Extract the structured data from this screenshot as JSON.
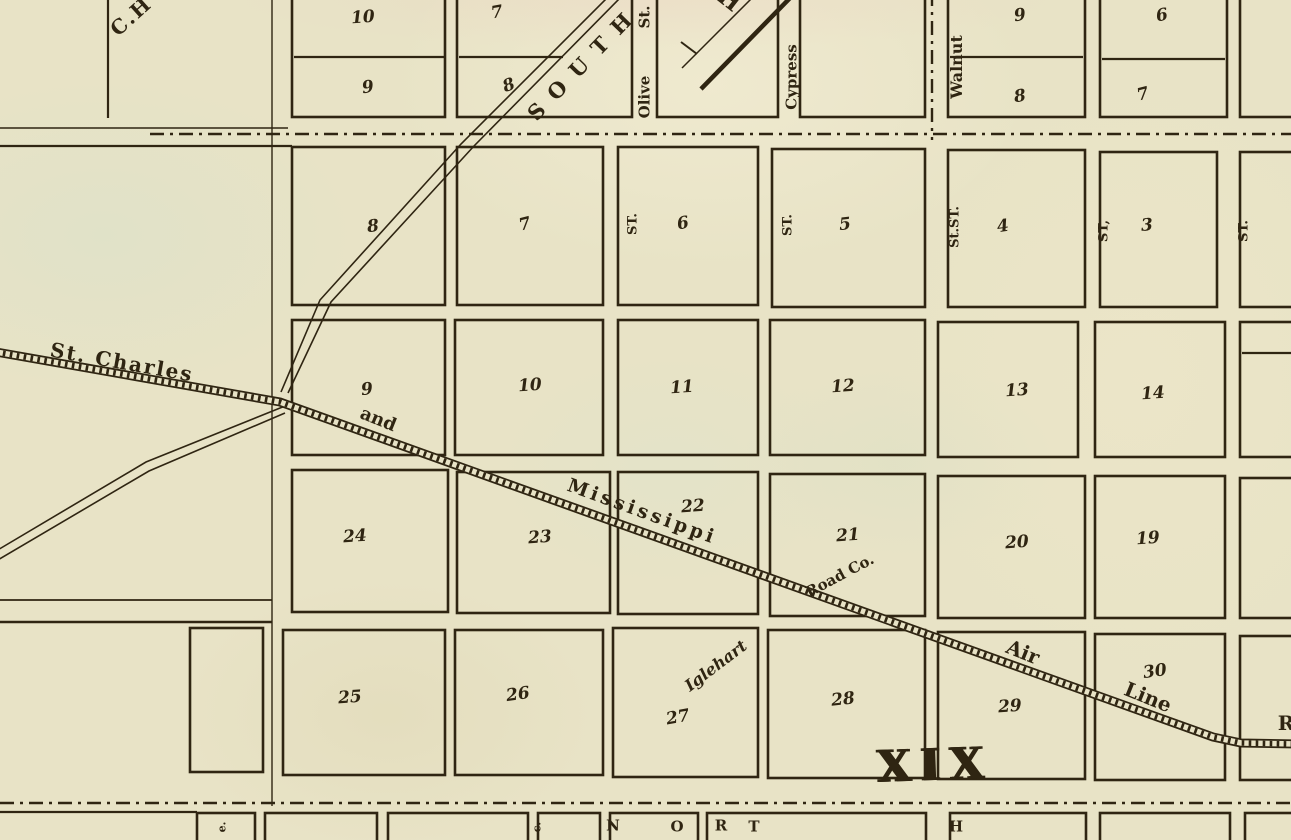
{
  "map": {
    "paper_color": "#e8e3c6",
    "ink_color": "#2f2512",
    "labels": [
      {
        "name": "partial-label-c-h",
        "text": "C.H",
        "x": 131,
        "y": 16,
        "rot": -42,
        "size": 20,
        "ls": 2,
        "w": 700
      },
      {
        "name": "road-label-south",
        "text": "SOUTH",
        "x": 584,
        "y": 62,
        "rot": -46,
        "size": 21,
        "ls": 13,
        "w": 700
      },
      {
        "name": "partial-label-h",
        "text": "H",
        "x": 729,
        "y": 0,
        "rot": 38,
        "size": 23,
        "w": 700
      },
      {
        "name": "street-label-olive",
        "text": "Olive",
        "x": 645,
        "y": 97,
        "rot": -90,
        "size": 15,
        "w": 700
      },
      {
        "name": "street-label-olive-st",
        "text": "St.",
        "x": 645,
        "y": 17,
        "rot": -90,
        "size": 15,
        "w": 700
      },
      {
        "name": "street-label-cypress",
        "text": "Cypress",
        "x": 792,
        "y": 77,
        "rot": -90,
        "size": 15,
        "w": 700
      },
      {
        "name": "street-label-walnut",
        "text": "Walnut",
        "x": 957,
        "y": 67,
        "rot": -90,
        "size": 16,
        "w": 700
      },
      {
        "name": "street-label-st-1",
        "text": "ST.",
        "x": 633,
        "y": 224,
        "rot": -90,
        "size": 13,
        "w": 700
      },
      {
        "name": "street-label-st-2",
        "text": "ST.",
        "x": 788,
        "y": 225,
        "rot": -90,
        "size": 13,
        "w": 700
      },
      {
        "name": "street-label-st-3",
        "text": "St.ST.",
        "x": 955,
        "y": 227,
        "rot": -90,
        "size": 13,
        "w": 700
      },
      {
        "name": "street-label-st-4",
        "text": "ST,",
        "x": 1104,
        "y": 231,
        "rot": -90,
        "size": 13,
        "w": 700
      },
      {
        "name": "street-label-st-5",
        "text": "ST.",
        "x": 1244,
        "y": 231,
        "rot": -90,
        "size": 13,
        "w": 700
      },
      {
        "name": "railroad-label-st-charles",
        "text": "St. Charles",
        "x": 122,
        "y": 362,
        "rot": 10,
        "size": 20,
        "ls": 2,
        "w": 700
      },
      {
        "name": "railroad-label-and",
        "text": "and",
        "x": 378,
        "y": 420,
        "rot": 22,
        "size": 18,
        "w": 700
      },
      {
        "name": "railroad-label-mississippi",
        "text": "Mississippi",
        "x": 642,
        "y": 512,
        "rot": 20,
        "size": 19,
        "ls": 3.5,
        "w": 700
      },
      {
        "name": "railroad-label-road-co",
        "text": "Road Co.",
        "x": 840,
        "y": 576,
        "rot": -28,
        "size": 15,
        "w": 700
      },
      {
        "name": "railroad-label-air",
        "text": "Air",
        "x": 1023,
        "y": 652,
        "rot": 22,
        "size": 20,
        "w": 700
      },
      {
        "name": "railroad-label-line",
        "text": "Line",
        "x": 1148,
        "y": 697,
        "rot": 22,
        "size": 20,
        "w": 700
      },
      {
        "name": "partial-label-r",
        "text": "R",
        "x": 1286,
        "y": 723,
        "rot": 0,
        "size": 20,
        "w": 700
      },
      {
        "name": "owner-label-iglehart",
        "text": "Iglehart",
        "x": 716,
        "y": 666,
        "rot": -37,
        "size": 16,
        "it": 1,
        "w": 700
      },
      {
        "name": "section-numeral-xix",
        "text": "XIX",
        "x": 934,
        "y": 766,
        "rot": -2,
        "size": 44,
        "ls": 9,
        "w": 700,
        "shadow": 1
      },
      {
        "name": "compass-letter-n",
        "text": "N",
        "x": 613,
        "y": 826,
        "rot": 0,
        "size": 15,
        "w": 700
      },
      {
        "name": "compass-letter-o",
        "text": "O",
        "x": 677,
        "y": 827,
        "rot": 0,
        "size": 15,
        "w": 700
      },
      {
        "name": "compass-letter-r",
        "text": "R",
        "x": 721,
        "y": 826,
        "rot": 0,
        "size": 15,
        "w": 700
      },
      {
        "name": "compass-letter-t",
        "text": "T",
        "x": 754,
        "y": 827,
        "rot": 0,
        "size": 15,
        "w": 700
      },
      {
        "name": "compass-letter-h",
        "text": "H",
        "x": 956,
        "y": 827,
        "rot": 0,
        "size": 15,
        "w": 700
      },
      {
        "name": "partial-street-label-1",
        "text": "e.",
        "x": 222,
        "y": 827,
        "rot": -90,
        "size": 11,
        "w": 700
      },
      {
        "name": "partial-street-label-2",
        "text": "c.",
        "x": 537,
        "y": 827,
        "rot": -90,
        "size": 11,
        "w": 700
      }
    ],
    "blocks": [
      {
        "n": "10",
        "x": 363,
        "y": 18,
        "rot": -4
      },
      {
        "n": "9",
        "x": 368,
        "y": 88,
        "rot": -8
      },
      {
        "n": "7",
        "x": 497,
        "y": 13,
        "rot": -10
      },
      {
        "n": "8",
        "x": 509,
        "y": 86,
        "rot": -20
      },
      {
        "n": "9",
        "x": 1020,
        "y": 16,
        "rot": -8
      },
      {
        "n": "8",
        "x": 1020,
        "y": 97,
        "rot": -8
      },
      {
        "n": "6",
        "x": 1162,
        "y": 16,
        "rot": -10
      },
      {
        "n": "7",
        "x": 1143,
        "y": 95,
        "rot": -14
      },
      {
        "n": "8",
        "x": 373,
        "y": 227,
        "rot": -6
      },
      {
        "n": "7",
        "x": 525,
        "y": 225,
        "rot": -14
      },
      {
        "n": "6",
        "x": 683,
        "y": 224,
        "rot": -10
      },
      {
        "n": "5",
        "x": 845,
        "y": 225,
        "rot": -6
      },
      {
        "n": "4",
        "x": 1003,
        "y": 227,
        "rot": -8
      },
      {
        "n": "3",
        "x": 1147,
        "y": 226,
        "rot": -4
      },
      {
        "n": "9",
        "x": 367,
        "y": 390,
        "rot": -6
      },
      {
        "n": "10",
        "x": 530,
        "y": 386,
        "rot": -4
      },
      {
        "n": "11",
        "x": 682,
        "y": 388,
        "rot": -4
      },
      {
        "n": "12",
        "x": 843,
        "y": 387,
        "rot": -4
      },
      {
        "n": "13",
        "x": 1017,
        "y": 391,
        "rot": -4
      },
      {
        "n": "14",
        "x": 1153,
        "y": 394,
        "rot": -4
      },
      {
        "n": "24",
        "x": 355,
        "y": 537,
        "rot": -4
      },
      {
        "n": "23",
        "x": 540,
        "y": 538,
        "rot": -4
      },
      {
        "n": "22",
        "x": 693,
        "y": 507,
        "rot": -4
      },
      {
        "n": "21",
        "x": 848,
        "y": 536,
        "rot": -4
      },
      {
        "n": "20",
        "x": 1017,
        "y": 543,
        "rot": -4
      },
      {
        "n": "19",
        "x": 1148,
        "y": 539,
        "rot": -4
      },
      {
        "n": "25",
        "x": 350,
        "y": 698,
        "rot": -4
      },
      {
        "n": "26",
        "x": 518,
        "y": 695,
        "rot": -8
      },
      {
        "n": "27",
        "x": 678,
        "y": 718,
        "rot": -10
      },
      {
        "n": "28",
        "x": 843,
        "y": 700,
        "rot": -6
      },
      {
        "n": "29",
        "x": 1010,
        "y": 707,
        "rot": -4
      },
      {
        "n": "30",
        "x": 1155,
        "y": 672,
        "rot": -8
      }
    ]
  }
}
